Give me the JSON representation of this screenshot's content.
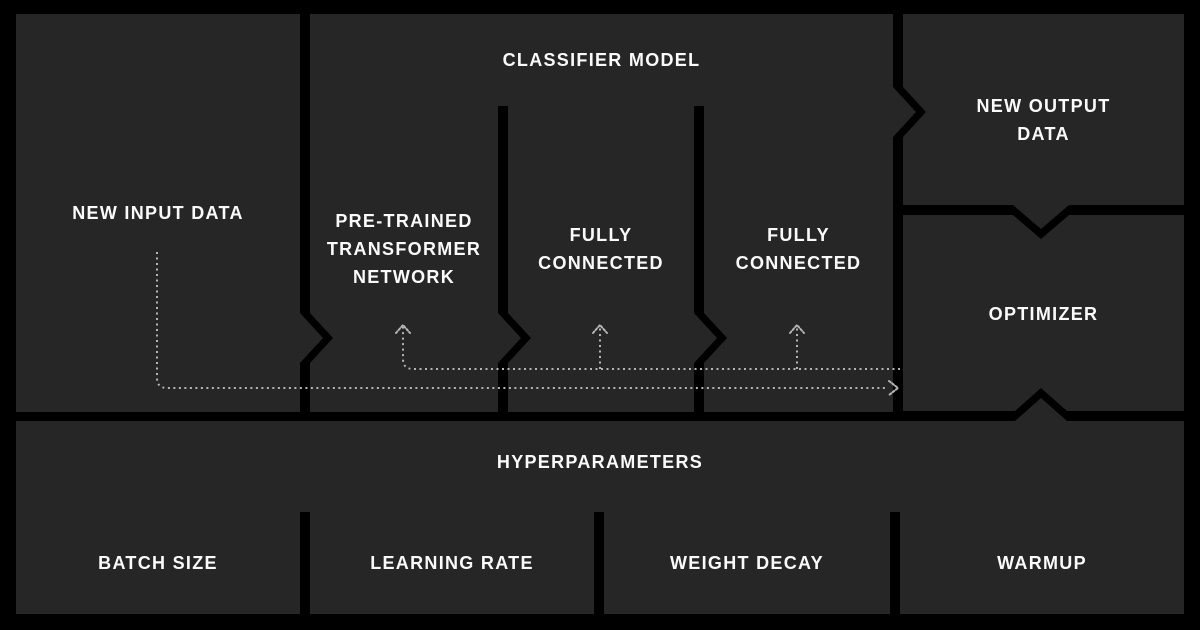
{
  "colors": {
    "background": "#000000",
    "box": "#262626",
    "divider": "#000000",
    "text": "#fafafa",
    "flow_line": "#b5b5b5"
  },
  "boxes": {
    "new_input_data": {
      "label": "NEW INPUT DATA"
    },
    "classifier_model": {
      "label": "CLASSIFIER MODEL",
      "children": [
        {
          "label": "PRE-TRAINED\nTRANSFORMER\nNETWORK"
        },
        {
          "label": "FULLY\nCONNECTED"
        },
        {
          "label": "FULLY\nCONNECTED"
        }
      ]
    },
    "new_output_data": {
      "label": "NEW OUTPUT\nDATA"
    },
    "optimizer": {
      "label": "OPTIMIZER"
    },
    "hyperparameters": {
      "label": "HYPERPARAMETERS",
      "children": [
        {
          "label": "BATCH SIZE"
        },
        {
          "label": "LEARNING RATE"
        },
        {
          "label": "WEIGHT DECAY"
        },
        {
          "label": "WARMUP"
        }
      ]
    }
  }
}
